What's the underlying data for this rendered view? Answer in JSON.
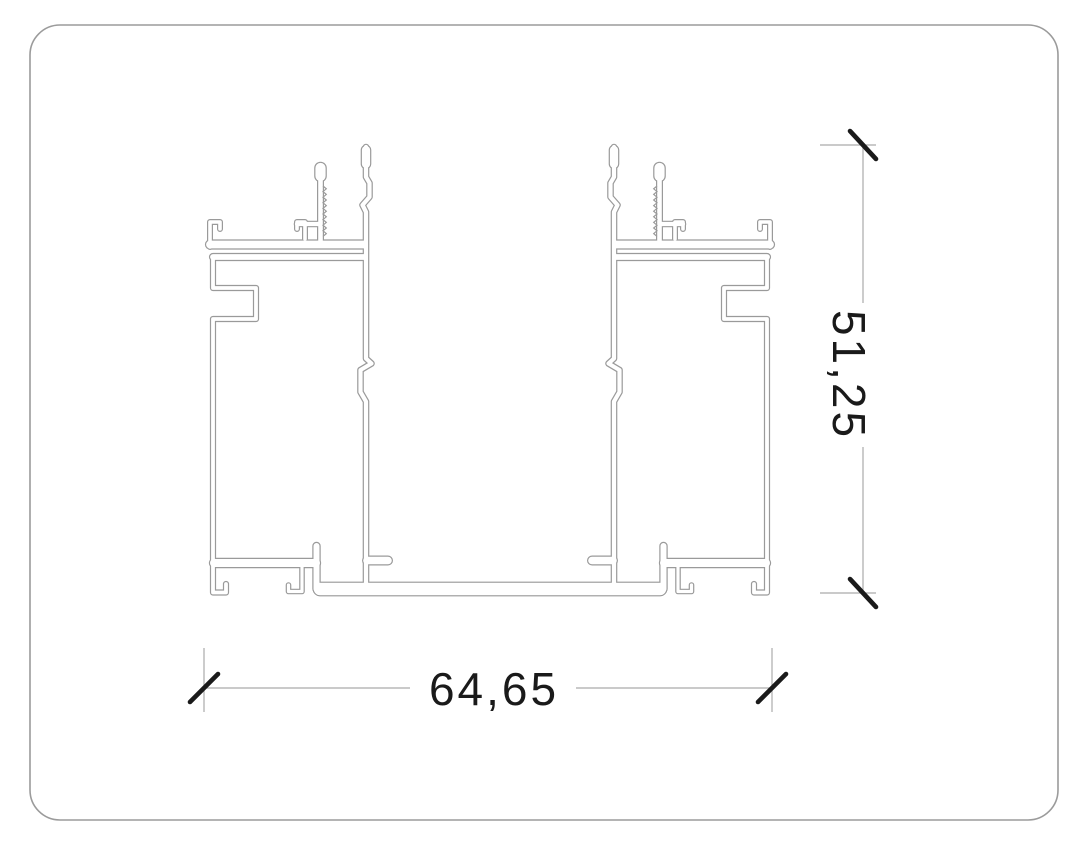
{
  "drawing": {
    "title": "Aluminium profile cross-section technical drawing",
    "dimensions": {
      "width_label": "64,65",
      "height_label": "51,25"
    },
    "colors": {
      "background": "#ffffff",
      "outline": "#9a9a9a",
      "dim_line": "#ababab",
      "ink": "#1a1a1a",
      "border": "#9b9b9b"
    }
  }
}
